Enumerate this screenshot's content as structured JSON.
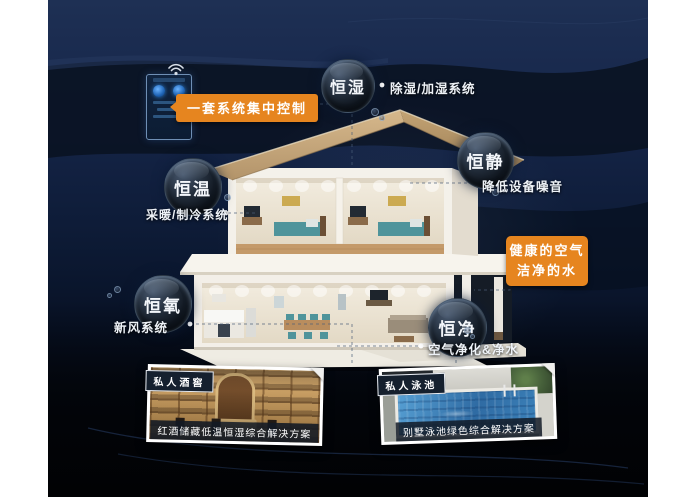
{
  "callouts": {
    "control_label": "一套系统集中控制",
    "water_air": {
      "line1": "健康的空气",
      "line2": "洁净的水"
    }
  },
  "bubbles": [
    {
      "label": "恒湿",
      "note": "除湿/加湿系统"
    },
    {
      "label": "恒静",
      "note": "降低设备噪音"
    },
    {
      "label": "恒温",
      "note": "采暖/制冷系统"
    },
    {
      "label": "恒氧",
      "note": "新风系统"
    },
    {
      "label": "恒净",
      "note": "空气净化&净水"
    }
  ],
  "photos": [
    {
      "badge": "私人酒窖",
      "caption": "红酒储藏低温恒湿综合解决方案"
    },
    {
      "badge": "私人泳池",
      "caption": "别墅泳池绿色综合解决方案"
    }
  ],
  "colors": {
    "accent_orange": "#e6851f",
    "panel_navy": "#13203d"
  }
}
